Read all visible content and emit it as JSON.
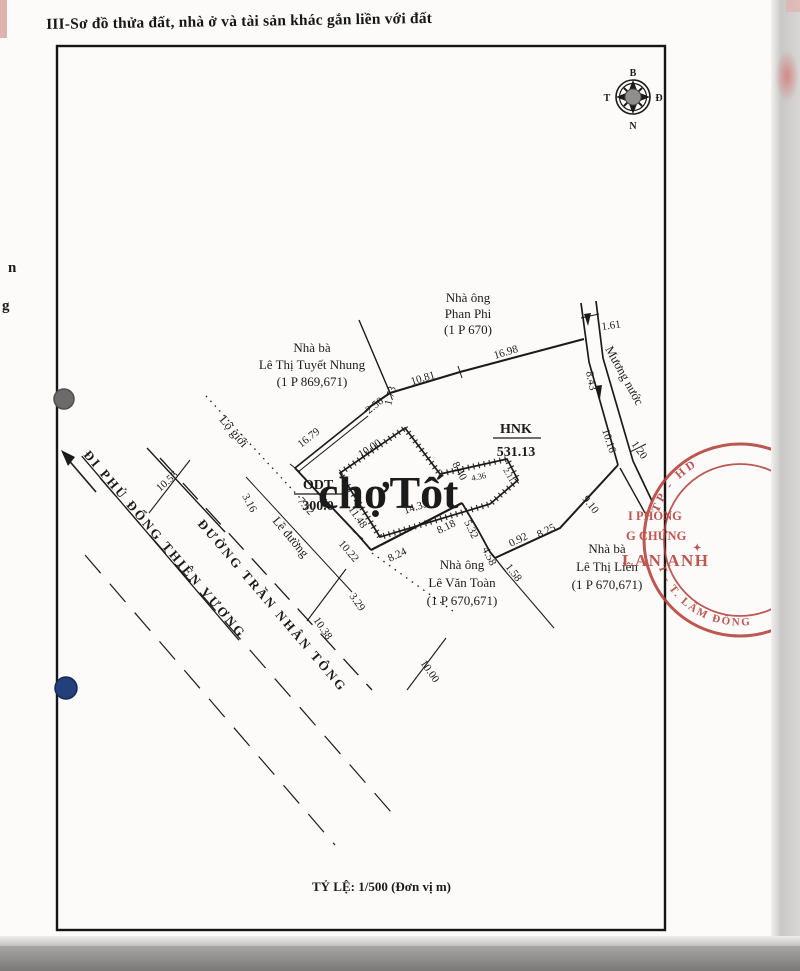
{
  "page": {
    "title": "III-Sơ đồ thửa đất, nhà ở và tài sản khác gắn liền với đất",
    "scale_label": "TỶ LỆ: 1/500 (Đơn vị m)",
    "watermark": "chợTốt",
    "edge_fragment_1": "n",
    "edge_fragment_2": "g"
  },
  "compass": {
    "north": "B",
    "east": "Đ",
    "south": "N",
    "west": "T"
  },
  "parcels": {
    "odt": {
      "code": "ODT",
      "area": "300.0"
    },
    "hnk": {
      "code": "HNK",
      "area": "531.13"
    }
  },
  "neighbors": {
    "phan_phi": {
      "line1": "Nhà ông",
      "line2": "Phan Phi",
      "line3": "(1 P 670)"
    },
    "tuyet_nhung": {
      "line1": "Nhà bà",
      "line2": "Lê Thị Tuyết Nhung",
      "line3": "(1 P 869,671)"
    },
    "van_toan": {
      "line1": "Nhà  ông",
      "line2": "Lê Văn Toàn",
      "line3": "(1 P 670,671)"
    },
    "thi_lien": {
      "line1": "Nhà bà",
      "line2": "Lê Thị Liên",
      "line3": "(1 P 670,671)"
    }
  },
  "features": {
    "canal": "Mương nước",
    "road_direction": "ĐI PHỦ ĐỔNG THIÊN VƯƠNG",
    "road_name": "ĐƯỜNG TRẦN NHÂN TÔNG",
    "lo_gioi": "Lộ giới",
    "le_duong": "Lề đường"
  },
  "m": {
    "top1": "10.81",
    "top2": "16.98",
    "jog1": "2.50",
    "jog2": "1.73",
    "nw": "16.79",
    "road1": "7.12",
    "road2": "10.22",
    "road3": "3.16",
    "cross_top": "10.56",
    "road4": "3.29",
    "cross_mid": "10.38",
    "cross_bot": "10.00",
    "south1": "8.24",
    "south2": "8.18",
    "house_bottom": "14.35",
    "house_left": "11.48",
    "house_top": "10.00",
    "house_right": "8.40",
    "ext_top": "4.36",
    "ext_right": "2.11",
    "east1": "5.32",
    "east2": "4.58",
    "east3": "1.58",
    "east4": "0.92",
    "east5": "8.25",
    "east6": "9.10",
    "canal1": "1.61",
    "canal2": "8.43",
    "canal3": "10.16",
    "canal4": "1.20"
  },
  "stamp": {
    "arc_top": "TP - HD",
    "line1": "I PHÒNG",
    "line2": "G CHỨNG",
    "name": "LAN ANH",
    "arc_bottom": "T - T. LÂM ĐỒNG",
    "color": "#b5413c"
  },
  "colors": {
    "ink": "#1b1b1b",
    "stamp_red": "#b5413c",
    "watermark": "#d88962",
    "gray_dot": "#6b6b6b",
    "blue_dot": "#24407c"
  }
}
